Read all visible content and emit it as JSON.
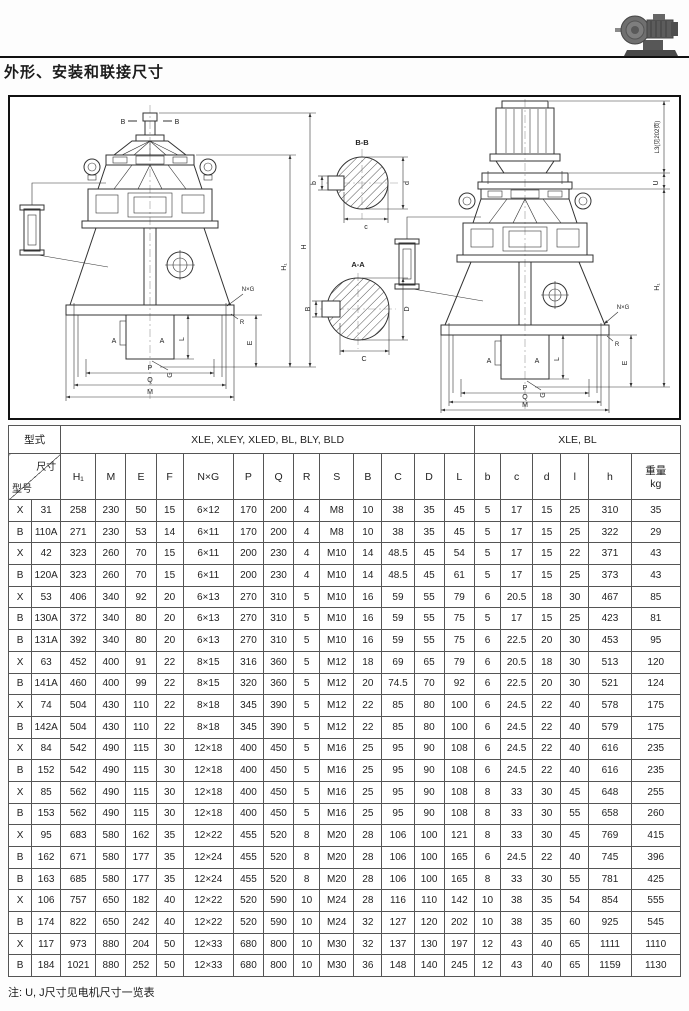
{
  "page": {
    "title": "外形、安装和联接尺寸",
    "note": "注: U, J尺寸见电机尺寸一览表"
  },
  "drawing": {
    "labels": {
      "H": "H",
      "H1": "H₁",
      "M": "M",
      "P": "P",
      "Q": "Q",
      "E": "E",
      "L": "L",
      "A": "A",
      "B": "B",
      "G": "G",
      "R": "R",
      "NxG": "N×G",
      "L3": "L3(见202页)",
      "U": "U",
      "section_bb": "B-B",
      "section_aa": "A-A",
      "b": "b",
      "c": "c",
      "d": "d",
      "C": "C",
      "D": "D"
    }
  },
  "table": {
    "header": {
      "type_label": "型式",
      "group1": "XLE, XLEY, XLED, BL, BLY, BLD",
      "group2": "XLE, BL",
      "diag_top": "尺寸",
      "diag_bottom": "型号",
      "columns": [
        "H₁",
        "M",
        "E",
        "F",
        "N×G",
        "P",
        "Q",
        "R",
        "S",
        "B",
        "C",
        "D",
        "L",
        "b",
        "c",
        "d",
        "l",
        "h"
      ],
      "weight_label": "重量",
      "weight_unit": "kg"
    },
    "rows": [
      [
        "X",
        "31",
        "258",
        "230",
        "50",
        "15",
        "6×12",
        "170",
        "200",
        "4",
        "M8",
        "10",
        "38",
        "35",
        "45",
        "5",
        "17",
        "15",
        "25",
        "310",
        "35"
      ],
      [
        "B",
        "110A",
        "271",
        "230",
        "53",
        "14",
        "6×11",
        "170",
        "200",
        "4",
        "M8",
        "10",
        "38",
        "35",
        "45",
        "5",
        "17",
        "15",
        "25",
        "322",
        "29"
      ],
      [
        "X",
        "42",
        "323",
        "260",
        "70",
        "15",
        "6×11",
        "200",
        "230",
        "4",
        "M10",
        "14",
        "48.5",
        "45",
        "54",
        "5",
        "17",
        "15",
        "22",
        "371",
        "43"
      ],
      [
        "B",
        "120A",
        "323",
        "260",
        "70",
        "15",
        "6×11",
        "200",
        "230",
        "4",
        "M10",
        "14",
        "48.5",
        "45",
        "61",
        "5",
        "17",
        "15",
        "25",
        "373",
        "43"
      ],
      [
        "X",
        "53",
        "406",
        "340",
        "92",
        "20",
        "6×13",
        "270",
        "310",
        "5",
        "M10",
        "16",
        "59",
        "55",
        "79",
        "6",
        "20.5",
        "18",
        "30",
        "467",
        "85"
      ],
      [
        "B",
        "130A",
        "372",
        "340",
        "80",
        "20",
        "6×13",
        "270",
        "310",
        "5",
        "M10",
        "16",
        "59",
        "55",
        "75",
        "5",
        "17",
        "15",
        "25",
        "423",
        "81"
      ],
      [
        "B",
        "131A",
        "392",
        "340",
        "80",
        "20",
        "6×13",
        "270",
        "310",
        "5",
        "M10",
        "16",
        "59",
        "55",
        "75",
        "6",
        "22.5",
        "20",
        "30",
        "453",
        "95"
      ],
      [
        "X",
        "63",
        "452",
        "400",
        "91",
        "22",
        "8×15",
        "316",
        "360",
        "5",
        "M12",
        "18",
        "69",
        "65",
        "79",
        "6",
        "20.5",
        "18",
        "30",
        "513",
        "120"
      ],
      [
        "B",
        "141A",
        "460",
        "400",
        "99",
        "22",
        "8×15",
        "320",
        "360",
        "5",
        "M12",
        "20",
        "74.5",
        "70",
        "92",
        "6",
        "22.5",
        "20",
        "30",
        "521",
        "124"
      ],
      [
        "X",
        "74",
        "504",
        "430",
        "110",
        "22",
        "8×18",
        "345",
        "390",
        "5",
        "M12",
        "22",
        "85",
        "80",
        "100",
        "6",
        "24.5",
        "22",
        "40",
        "578",
        "175"
      ],
      [
        "B",
        "142A",
        "504",
        "430",
        "110",
        "22",
        "8×18",
        "345",
        "390",
        "5",
        "M12",
        "22",
        "85",
        "80",
        "100",
        "6",
        "24.5",
        "22",
        "40",
        "579",
        "175"
      ],
      [
        "X",
        "84",
        "542",
        "490",
        "115",
        "30",
        "12×18",
        "400",
        "450",
        "5",
        "M16",
        "25",
        "95",
        "90",
        "108",
        "6",
        "24.5",
        "22",
        "40",
        "616",
        "235"
      ],
      [
        "B",
        "152",
        "542",
        "490",
        "115",
        "30",
        "12×18",
        "400",
        "450",
        "5",
        "M16",
        "25",
        "95",
        "90",
        "108",
        "6",
        "24.5",
        "22",
        "40",
        "616",
        "235"
      ],
      [
        "X",
        "85",
        "562",
        "490",
        "115",
        "30",
        "12×18",
        "400",
        "450",
        "5",
        "M16",
        "25",
        "95",
        "90",
        "108",
        "8",
        "33",
        "30",
        "45",
        "648",
        "255"
      ],
      [
        "B",
        "153",
        "562",
        "490",
        "115",
        "30",
        "12×18",
        "400",
        "450",
        "5",
        "M16",
        "25",
        "95",
        "90",
        "108",
        "8",
        "33",
        "30",
        "55",
        "658",
        "260"
      ],
      [
        "X",
        "95",
        "683",
        "580",
        "162",
        "35",
        "12×22",
        "455",
        "520",
        "8",
        "M20",
        "28",
        "106",
        "100",
        "121",
        "8",
        "33",
        "30",
        "45",
        "769",
        "415"
      ],
      [
        "B",
        "162",
        "671",
        "580",
        "177",
        "35",
        "12×24",
        "455",
        "520",
        "8",
        "M20",
        "28",
        "106",
        "100",
        "165",
        "6",
        "24.5",
        "22",
        "40",
        "745",
        "396"
      ],
      [
        "B",
        "163",
        "685",
        "580",
        "177",
        "35",
        "12×24",
        "455",
        "520",
        "8",
        "M20",
        "28",
        "106",
        "100",
        "165",
        "8",
        "33",
        "30",
        "55",
        "781",
        "425"
      ],
      [
        "X",
        "106",
        "757",
        "650",
        "182",
        "40",
        "12×22",
        "520",
        "590",
        "10",
        "M24",
        "28",
        "116",
        "110",
        "142",
        "10",
        "38",
        "35",
        "54",
        "854",
        "555"
      ],
      [
        "B",
        "174",
        "822",
        "650",
        "242",
        "40",
        "12×22",
        "520",
        "590",
        "10",
        "M24",
        "32",
        "127",
        "120",
        "202",
        "10",
        "38",
        "35",
        "60",
        "925",
        "545"
      ],
      [
        "X",
        "117",
        "973",
        "880",
        "204",
        "50",
        "12×33",
        "680",
        "800",
        "10",
        "M30",
        "32",
        "137",
        "130",
        "197",
        "12",
        "43",
        "40",
        "65",
        "1111",
        "1110"
      ],
      [
        "B",
        "184",
        "1021",
        "880",
        "252",
        "50",
        "12×33",
        "680",
        "800",
        "10",
        "M30",
        "36",
        "148",
        "140",
        "245",
        "12",
        "43",
        "40",
        "65",
        "1159",
        "1130"
      ]
    ]
  }
}
